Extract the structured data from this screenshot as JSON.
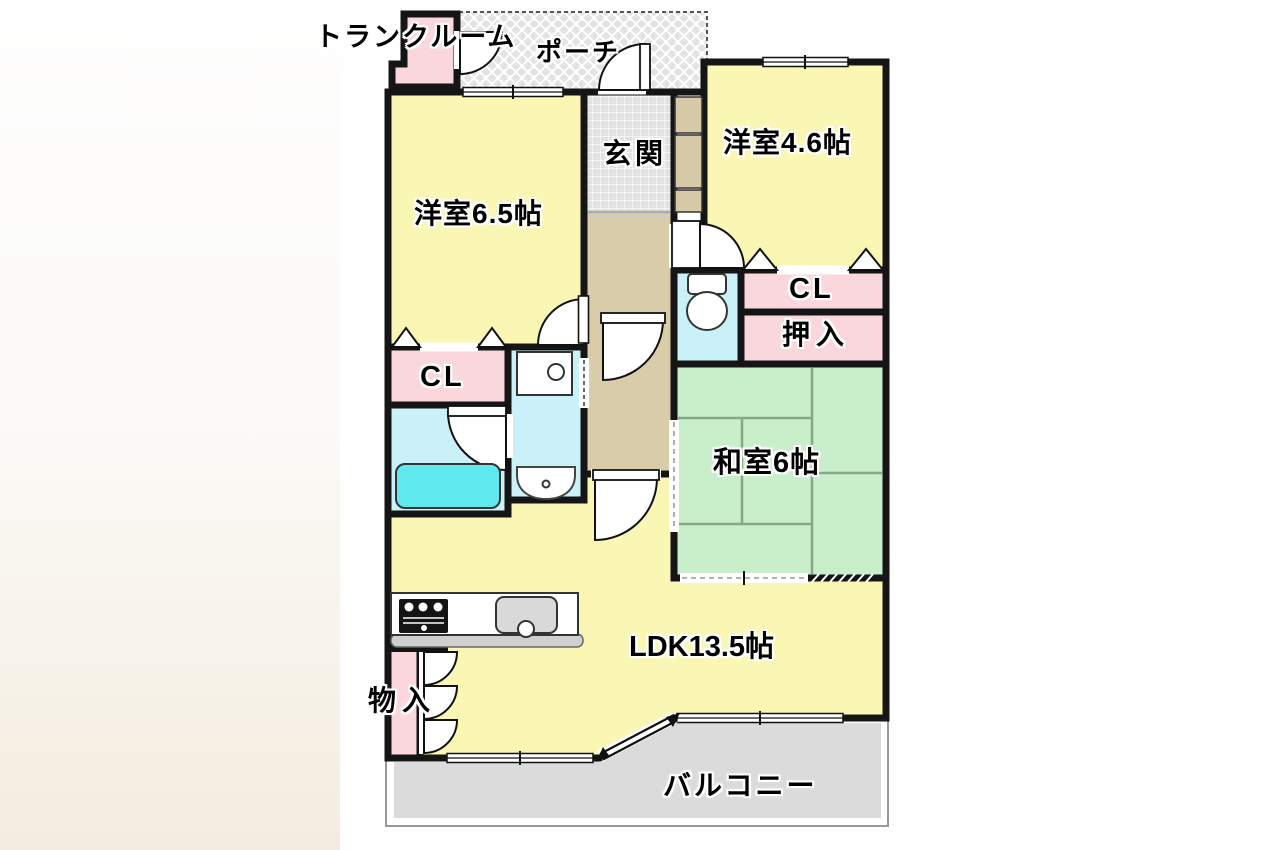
{
  "labels": {
    "trunk_room": "トランクルーム",
    "porch": "ポーチ",
    "entrance": "玄関",
    "western_room_46": "洋室4.6帖",
    "western_room_65": "洋室6.5帖",
    "closet_upper": "CL",
    "oshiire": "押入",
    "closet_left": "CL",
    "japanese_room": "和室6帖",
    "ldk": "LDK13.5帖",
    "storage": "物入",
    "balcony": "バルコニー"
  },
  "colors": {
    "room_yellow": "#faf6b4",
    "room_pink": "#f9d7dc",
    "room_green": "#c8eeca",
    "hall_beige": "#d9cca9",
    "cabinet_tan": "#d6c9a8",
    "water_cyan": "#c9f1f7",
    "bathtub_cyan": "#5fe9ee",
    "tile_grey": "#e2e2e2",
    "balcony_grey": "#dbdbdb",
    "wall_black": "#151515",
    "tatami_line_green": "#86a886"
  }
}
